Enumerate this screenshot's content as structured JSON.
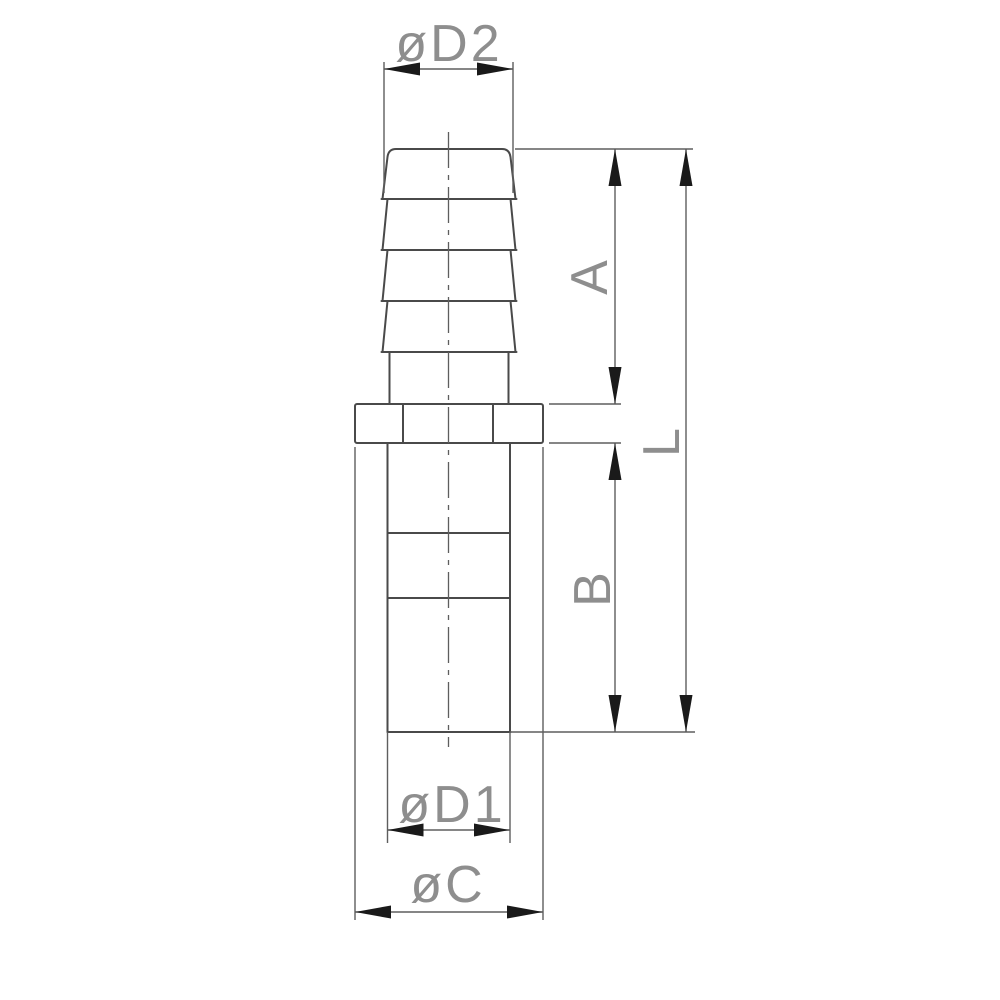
{
  "labels": {
    "d2": "øD2",
    "a": "A",
    "l": "L",
    "b": "B",
    "d1": "øD1",
    "c": "øC"
  },
  "colors": {
    "outline": "#4a4a4a",
    "dimension_line": "#5e5e5e",
    "arrow": "#1a1a1a",
    "label_text": "#8e8e8e",
    "background": "#ffffff"
  }
}
